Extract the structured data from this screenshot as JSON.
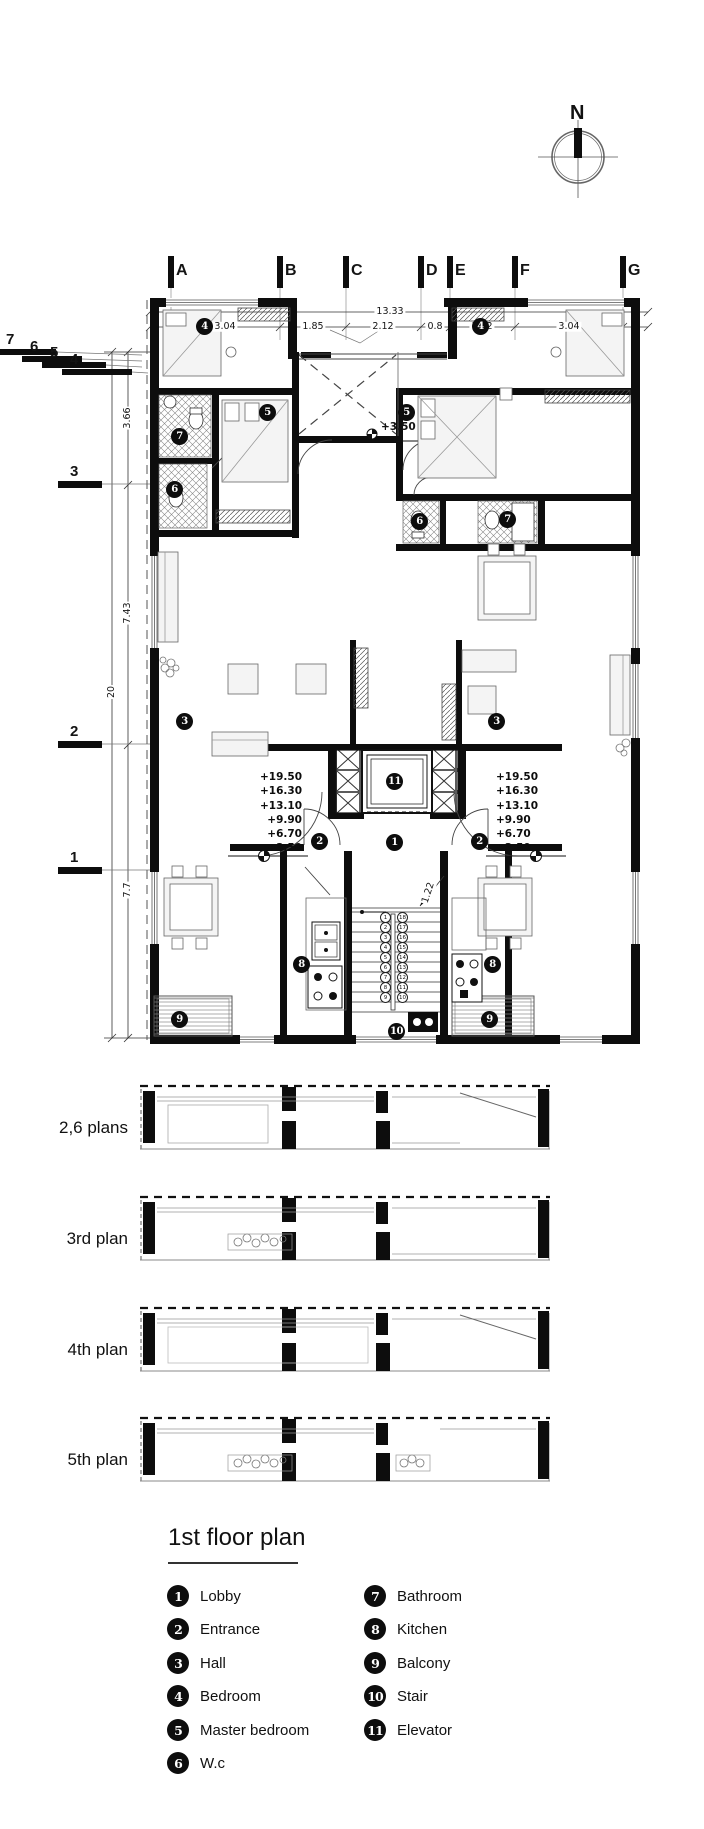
{
  "compass": {
    "label": "N"
  },
  "grid": {
    "cols": [
      {
        "label": "A"
      },
      {
        "label": "B"
      },
      {
        "label": "C"
      },
      {
        "label": "D"
      },
      {
        "label": "E"
      },
      {
        "label": "F"
      },
      {
        "label": "G"
      }
    ],
    "rows_left": [
      {
        "label": "3"
      },
      {
        "label": "2"
      },
      {
        "label": "1"
      }
    ],
    "rows_top": [
      {
        "label": "7"
      },
      {
        "label": "6"
      },
      {
        "label": "5"
      },
      {
        "label": "4"
      }
    ]
  },
  "dimensions": {
    "overall_width": "13.33",
    "top_segments": [
      "3.04",
      "1.85",
      "2.12",
      "0.8",
      "1.82",
      "3.04"
    ],
    "left_segments": [
      "3.66",
      "7.43",
      "7.7"
    ],
    "overall_height": "20",
    "stair_width": "1.22"
  },
  "levels": {
    "left": [
      "+19.50",
      "+16.30",
      "+13.10",
      "+9.90",
      "+6.70",
      "+3.50"
    ],
    "right": [
      "+19.50",
      "+16.30",
      "+13.10",
      "+9.90",
      "+6.70",
      "+3.50"
    ],
    "terrace": "+3.50"
  },
  "room_markers": [
    {
      "num": "1"
    },
    {
      "num": "2"
    },
    {
      "num": "2"
    },
    {
      "num": "3"
    },
    {
      "num": "3"
    },
    {
      "num": "4"
    },
    {
      "num": "4"
    },
    {
      "num": "5"
    },
    {
      "num": "5"
    },
    {
      "num": "6"
    },
    {
      "num": "6"
    },
    {
      "num": "7"
    },
    {
      "num": "7"
    },
    {
      "num": "8"
    },
    {
      "num": "8"
    },
    {
      "num": "9"
    },
    {
      "num": "9"
    },
    {
      "num": "10"
    },
    {
      "num": "11"
    }
  ],
  "stairs": {
    "col_a": [
      "1",
      "2",
      "3",
      "4",
      "5",
      "6",
      "7",
      "8",
      "9"
    ],
    "col_b": [
      "18",
      "17",
      "16",
      "15",
      "14",
      "13",
      "12",
      "11",
      "10"
    ]
  },
  "strips": [
    {
      "label": "2,6 plans"
    },
    {
      "label": "3rd plan"
    },
    {
      "label": "4th plan"
    },
    {
      "label": "5th plan"
    }
  ],
  "legend": {
    "title": "1st floor plan",
    "items_left": [
      {
        "num": "1",
        "label": "Lobby"
      },
      {
        "num": "2",
        "label": "Entrance"
      },
      {
        "num": "3",
        "label": "Hall"
      },
      {
        "num": "4",
        "label": "Bedroom"
      },
      {
        "num": "5",
        "label": "Master bedroom"
      },
      {
        "num": "6",
        "label": "W.c"
      }
    ],
    "items_right": [
      {
        "num": "7",
        "label": "Bathroom"
      },
      {
        "num": "8",
        "label": "Kitchen"
      },
      {
        "num": "9",
        "label": "Balcony"
      },
      {
        "num": "10",
        "label": "Stair"
      },
      {
        "num": "11",
        "label": "Elevator"
      }
    ]
  },
  "colors": {
    "ink": "#111111",
    "line": "#555555",
    "light": "#bbbbbb"
  }
}
